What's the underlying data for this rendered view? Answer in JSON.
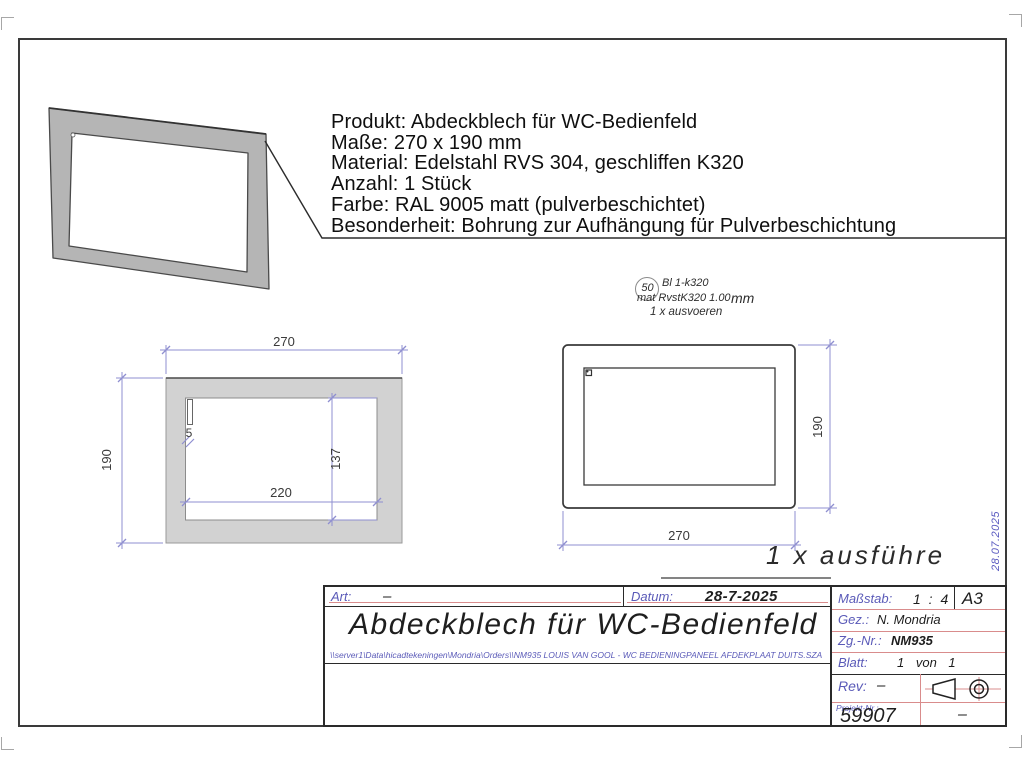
{
  "notes": {
    "lines": [
      "Produkt: Abdeckblech für WC-Bedienfeld",
      "Maße: 270 x 190 mm",
      "Material: Edelstahl RVS 304, geschliffen K320",
      "Anzahl: 1 Stück",
      "Farbe: RAL 9005 matt (pulverbeschichtet)",
      "Besonderheit: Bohrung zur Aufhängung für Pulverbeschichtung"
    ]
  },
  "balloon": {
    "number": "50",
    "line1": "Bl 1-k320",
    "line2": "mat RvstK320 1.00",
    "line2_unit": "mm",
    "line3": "1 x ausvoeren"
  },
  "views": {
    "front": {
      "outer_width": "270",
      "outer_height": "190",
      "inner_width": "220",
      "inner_height": "137",
      "slot_width": "5"
    },
    "back": {
      "width": "270",
      "height": "190"
    }
  },
  "callout": "1 x ausführe",
  "side_date": "28.07.2025",
  "title_block": {
    "art_label": "Art:",
    "art_value": "–",
    "datum_label": "Datum:",
    "datum_value": "28-7-2025",
    "title": "Abdeckblech für WC-Bedienfeld",
    "file_path": "\\\\server1\\Data\\hicadtekeningen\\Mondria\\Orders\\\\NM935 LOUIS VAN GOOL - WC BEDIENINGPANEEL AFDEKPLAAT DUITS.SZA",
    "massstab_label": "Maßstab:",
    "massstab_value": "1 : 4",
    "format": "A3",
    "gez_label": "Gez.:",
    "gez_value": "N. Mondria",
    "zgnr_label": "Zg.-Nr.:",
    "zgnr_value": "NM935",
    "blatt_label": "Blatt:",
    "blatt_value": "1  von  1",
    "rev_label": "Rev:",
    "rev_value": "–",
    "projekt_label": "Projekt-Nr.:",
    "projekt_value": "59907",
    "projekt_right": "–"
  },
  "colors": {
    "dimension_blue": "#8f8fd0",
    "grid_red": "#d98c8c",
    "label_blue": "#5a5ab8",
    "plate_gray": "#b5b5b5"
  }
}
